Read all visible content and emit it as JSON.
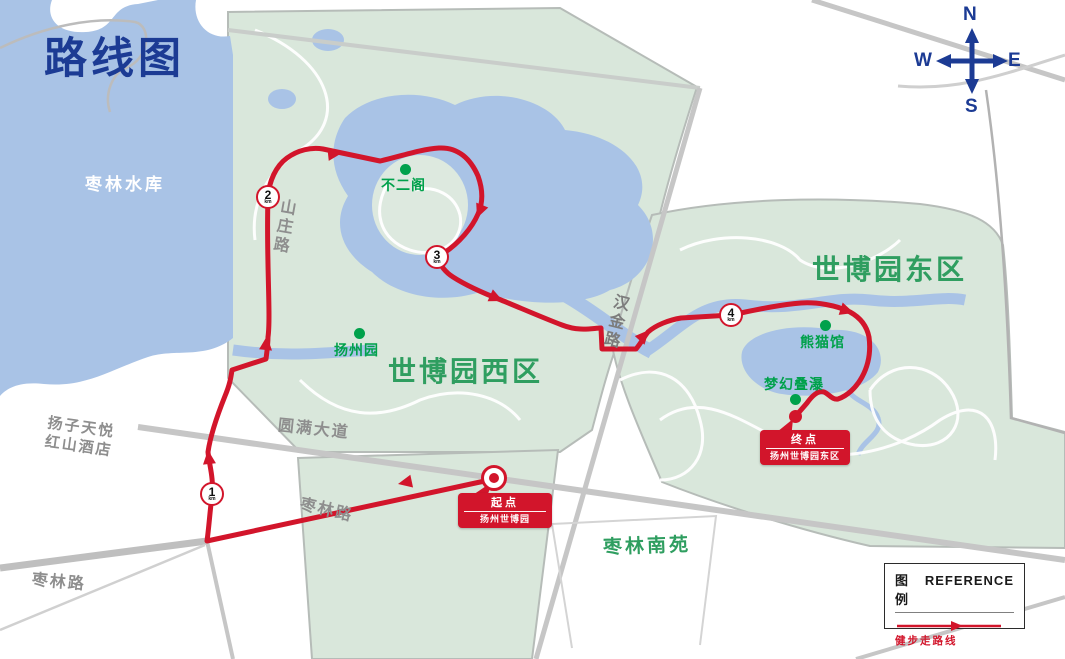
{
  "map": {
    "title": "路线图",
    "compass": {
      "north": "N",
      "south": "S",
      "east": "E",
      "west": "W"
    },
    "water_labels": {
      "reservoir": "枣林水库"
    },
    "region_labels": {
      "expo_west": "世博园西区",
      "expo_east": "世博园东区",
      "zaolin_south": "枣林南苑"
    },
    "road_labels": {
      "shanzhuang": "山庄路",
      "hanjin": "汉金路",
      "yuanman_avenue": "圆满大道",
      "zaolin_mid": "枣林路",
      "zaolin_southwest": "枣林路"
    },
    "place_labels": {
      "hotel_line1": "扬子天悦",
      "hotel_line2": "红山酒店"
    },
    "pois": [
      {
        "name": "buerge-pavilion",
        "label": "不二阁"
      },
      {
        "name": "yangzhou-garden",
        "label": "扬州园"
      },
      {
        "name": "panda-house",
        "label": "熊猫馆"
      },
      {
        "name": "dream-waterfall",
        "label": "梦幻叠瀑"
      }
    ],
    "km_markers": [
      {
        "number": "1",
        "unit": "km"
      },
      {
        "number": "2",
        "unit": "km"
      },
      {
        "number": "3",
        "unit": "km"
      },
      {
        "number": "4",
        "unit": "km"
      }
    ],
    "start_badge": {
      "title": "起点",
      "subtitle": "扬州世博园"
    },
    "finish_badge": {
      "title": "终点",
      "subtitle": "扬州世博园东区"
    },
    "legend": {
      "title_zh": "图例",
      "title_en": "REFERENCE",
      "route_label": "健步走路线"
    },
    "colors": {
      "route_red": "#d2152b",
      "water_blue": "#a9c3e6",
      "park_green": "#d9e7db",
      "poi_green": "#00a14b",
      "region_green": "#2f9e60",
      "title_blue": "#1c3b94",
      "road_gray": "#c9cdca"
    }
  }
}
